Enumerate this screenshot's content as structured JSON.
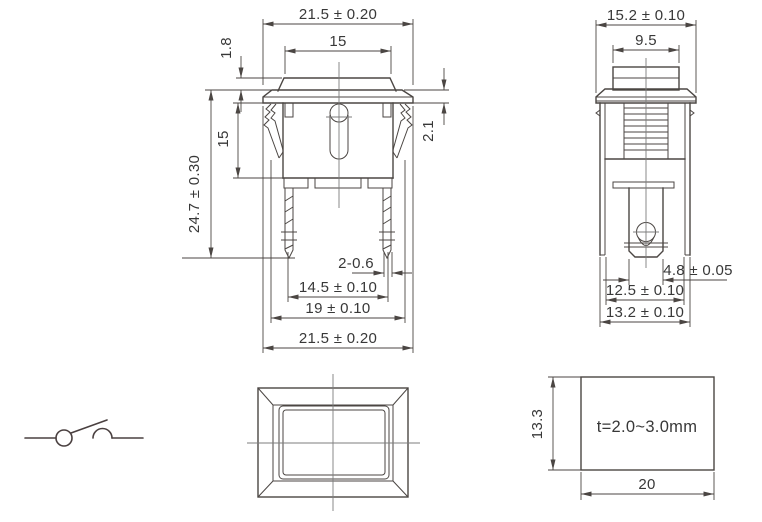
{
  "dims": {
    "front": {
      "top_width": "21.5 ± 0.20",
      "button_width": "15",
      "button_height": "1.8",
      "overall_height": "24.7 ± 0.30",
      "body_height": "15",
      "flange_thickness": "2.1",
      "terminal_thickness": "2-0.6",
      "terminal_spacing": "14.5 ± 0.10",
      "body_width": "19 ± 0.10",
      "bottom_width": "21.5 ± 0.20"
    },
    "side": {
      "overall_width": "15.2 ± 0.10",
      "button_depth": "9.5",
      "terminal_width": "4.8 ± 0.05",
      "body_depth": "12.5 ± 0.10",
      "flange_depth": "13.2 ± 0.10"
    },
    "cutout": {
      "height": "13.3",
      "width": "20",
      "panel_thickness": "t=2.0~3.0mm"
    }
  }
}
